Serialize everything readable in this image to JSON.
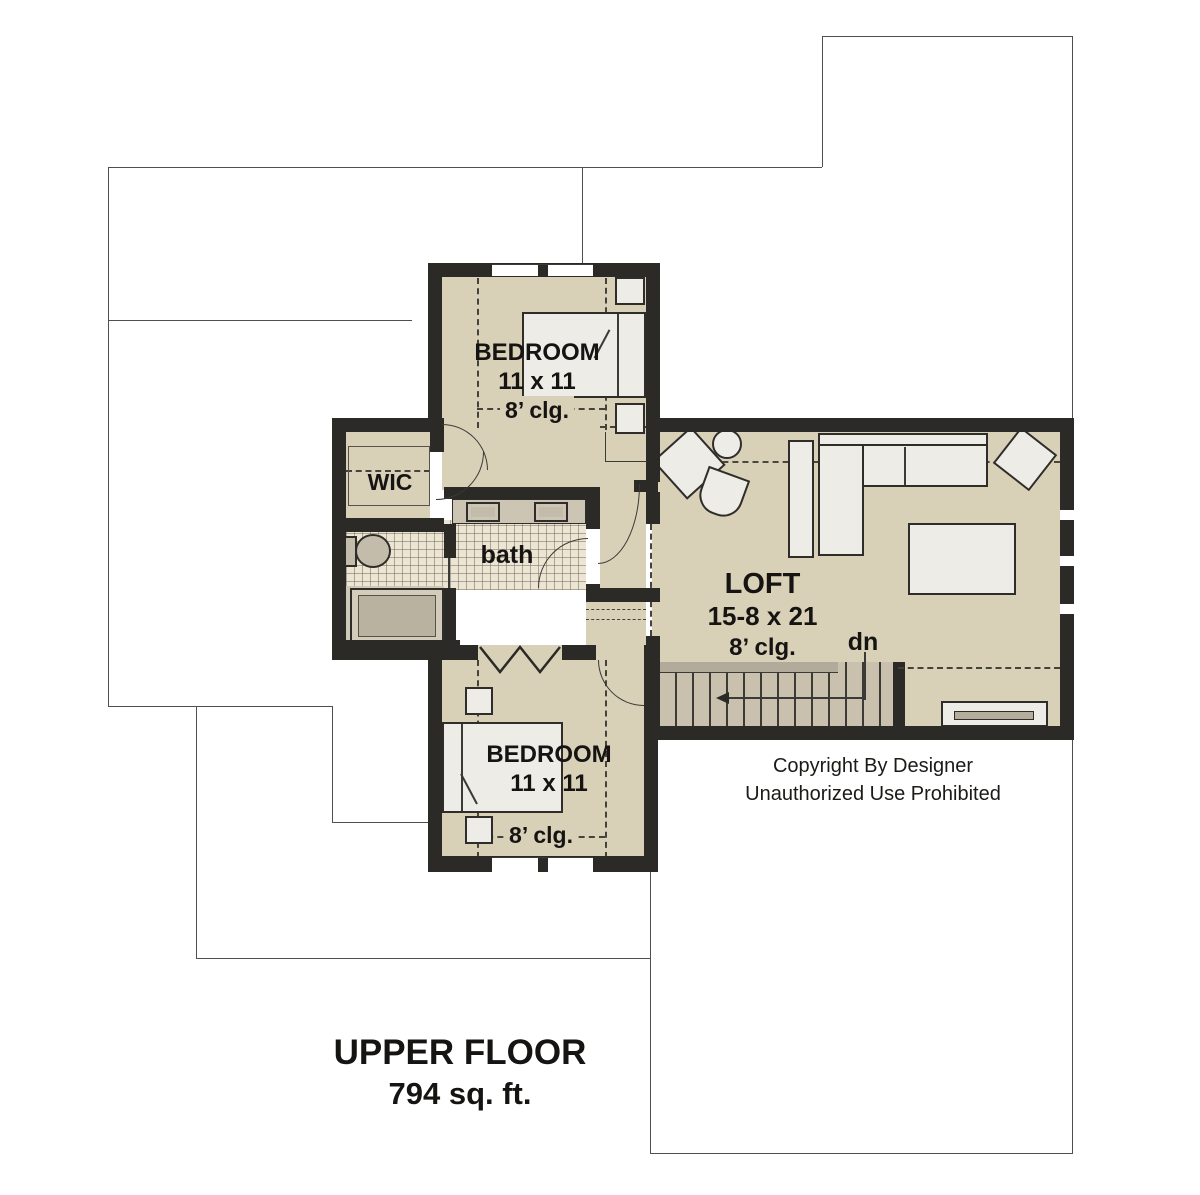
{
  "plan": {
    "rooms": {
      "bedroom_top": {
        "name": "BEDROOM",
        "dims": "11 x 11",
        "ceiling": "8’ clg."
      },
      "bedroom_bottom": {
        "name": "BEDROOM",
        "dims": "11 x 11",
        "ceiling": "8’ clg."
      },
      "loft": {
        "name": "LOFT",
        "dims": "15-8 x 21",
        "ceiling": "8’ clg."
      },
      "wic": {
        "name": "WIC"
      },
      "bath": {
        "name": "bath"
      },
      "stair": {
        "down_label": "dn"
      }
    },
    "copyright": {
      "line1": "Copyright By Designer",
      "line2": "Unauthorized Use Prohibited"
    },
    "footer": {
      "title": "UPPER FLOOR",
      "area": "794 sq. ft."
    },
    "colors": {
      "wall": "#2b2a26",
      "floor": "#d9d0b8",
      "tile": "#ece5d4",
      "stair": "#c9c0ae",
      "fixture": "#c4bcab",
      "furniture": "#edece6",
      "line": "#2e2d29",
      "outline": "#4f4f4f"
    }
  }
}
